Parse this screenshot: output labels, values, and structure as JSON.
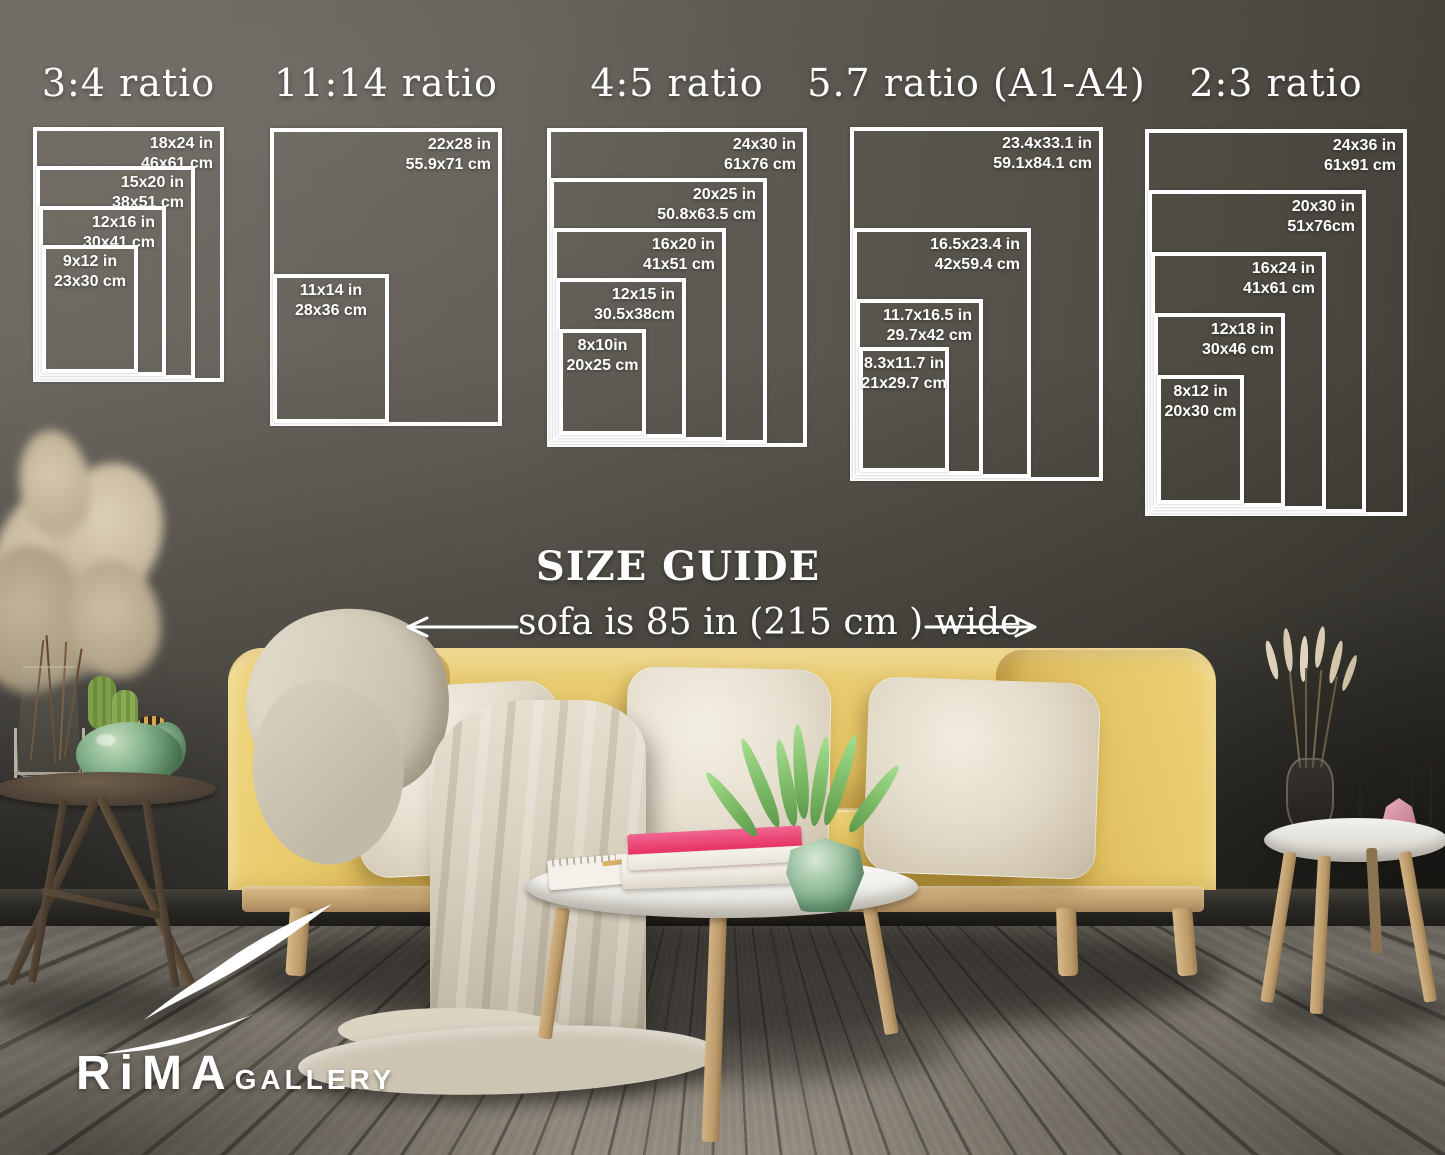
{
  "page": {
    "kind": "poster-size-guide-mockup"
  },
  "palette": {
    "overlay_text": "#ffffff",
    "wall": "#5e5a53",
    "floor": "#7c766b",
    "sofa_yellow": "#e2c261",
    "pillow_cream": "#e9e3d5",
    "blanket_beige": "#d8d1c2",
    "wood": "#c9a97c",
    "plant_green": "#8cc47c",
    "vase_jade": "#7fae8a",
    "book_pink": "#e73a6e"
  },
  "overlay": {
    "size_guide_title": "SIZE GUIDE",
    "sofa_width_note": "sofa is 85 in (215 cm ) wide",
    "logo_brand": "RiMA",
    "logo_suffix": "GALLERY"
  },
  "ratio_groups": [
    {
      "title": "3:4 ratio",
      "frame": {
        "left": 33,
        "top": 127,
        "width": 191,
        "height": 255
      },
      "sizes": [
        {
          "inches": "18x24 in",
          "cm": "46x61 cm",
          "w": 18,
          "h": 24
        },
        {
          "inches": "15x20 in",
          "cm": "38x51 cm",
          "w": 15,
          "h": 20
        },
        {
          "inches": "12x16 in",
          "cm": "30x41 cm",
          "w": 12,
          "h": 16
        },
        {
          "inches": "9x12 in",
          "cm": "23x30 cm",
          "w": 9,
          "h": 12
        }
      ]
    },
    {
      "title": "11:14 ratio",
      "frame": {
        "left": 270,
        "top": 128,
        "width": 232,
        "height": 298
      },
      "sizes": [
        {
          "inches": "22x28 in",
          "cm": "55.9x71 cm",
          "w": 22,
          "h": 28
        },
        {
          "inches": "11x14 in",
          "cm": "28x36 cm",
          "w": 11,
          "h": 14
        }
      ]
    },
    {
      "title": "4:5 ratio",
      "frame": {
        "left": 547,
        "top": 128,
        "width": 260,
        "height": 319
      },
      "sizes": [
        {
          "inches": "24x30 in",
          "cm": "61x76 cm",
          "w": 24,
          "h": 30
        },
        {
          "inches": "20x25 in",
          "cm": "50.8x63.5 cm",
          "w": 20,
          "h": 25
        },
        {
          "inches": "16x20 in",
          "cm": "41x51 cm",
          "w": 16,
          "h": 20
        },
        {
          "inches": "12x15 in",
          "cm": "30.5x38cm",
          "w": 12,
          "h": 15
        },
        {
          "inches": "8x10in",
          "cm": "20x25 cm",
          "w": 8,
          "h": 10
        }
      ]
    },
    {
      "title": "5.7 ratio (A1-A4)",
      "frame": {
        "left": 850,
        "top": 127,
        "width": 253,
        "height": 354
      },
      "sizes": [
        {
          "inches": "23.4x33.1 in",
          "cm": "59.1x84.1 cm",
          "w": 23.4,
          "h": 33.1
        },
        {
          "inches": "16.5x23.4 in",
          "cm": "42x59.4 cm",
          "w": 16.5,
          "h": 23.4
        },
        {
          "inches": "11.7x16.5 in",
          "cm": "29.7x42 cm",
          "w": 11.7,
          "h": 16.5
        },
        {
          "inches": "8.3x11.7 in",
          "cm": "21x29.7 cm",
          "w": 8.3,
          "h": 11.7
        }
      ]
    },
    {
      "title": "2:3 ratio",
      "frame": {
        "left": 1145,
        "top": 129,
        "width": 262,
        "height": 387
      },
      "sizes": [
        {
          "inches": "24x36 in",
          "cm": "61x91 cm",
          "w": 24,
          "h": 36
        },
        {
          "inches": "20x30 in",
          "cm": "51x76cm",
          "w": 20,
          "h": 30
        },
        {
          "inches": "16x24 in",
          "cm": "41x61 cm",
          "w": 16,
          "h": 24
        },
        {
          "inches": "12x18 in",
          "cm": "30x46 cm",
          "w": 12,
          "h": 18
        },
        {
          "inches": "8x12 in",
          "cm": "20x30 cm",
          "w": 8,
          "h": 12
        }
      ]
    }
  ]
}
